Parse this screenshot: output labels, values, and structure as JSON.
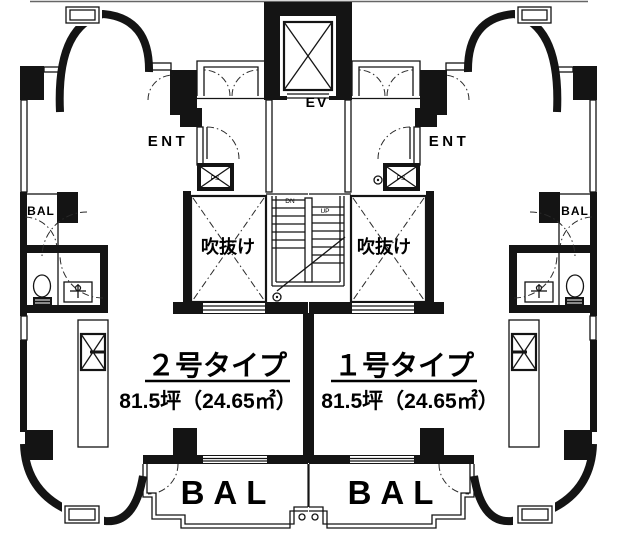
{
  "units": [
    {
      "name": "２号タイプ",
      "area": "81.5坪（24.65㎡）"
    },
    {
      "name": "１号タイプ",
      "area": "81.5坪（24.65㎡）"
    }
  ],
  "labels": {
    "elevator": "EV",
    "entrance": "ENT",
    "void": "吹抜け",
    "balcony": "BAL",
    "pipe_space": "PS",
    "stairs_down": "DN",
    "stairs_up": "UP"
  },
  "colors": {
    "line": "#141414",
    "background": "#ffffff",
    "text": "#000000"
  }
}
